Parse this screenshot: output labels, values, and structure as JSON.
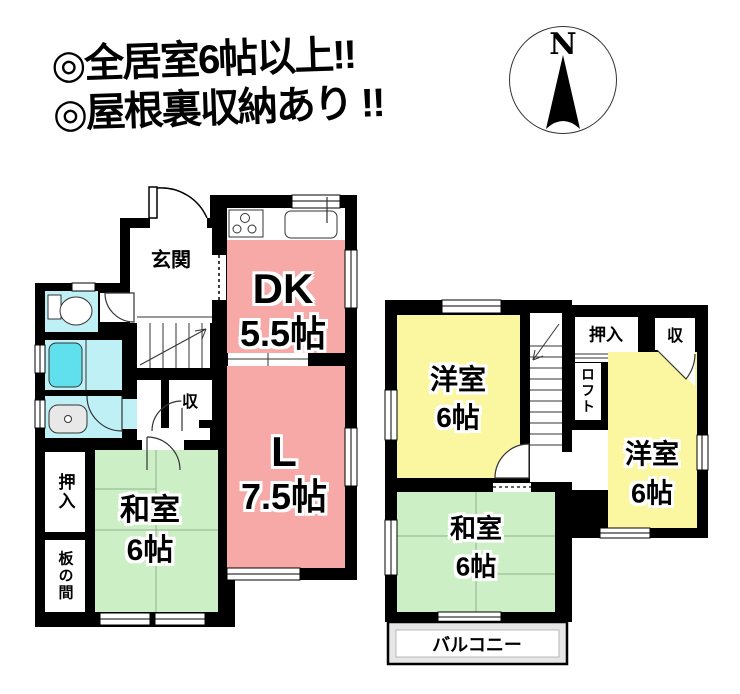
{
  "banner": {
    "line1": "◎全居室6帖以上!!",
    "line2": "◎屋根裏収納あり !!"
  },
  "compass": {
    "label": "N"
  },
  "floor1": {
    "entrance": "玄関",
    "dk_label": "DK",
    "dk_size": "5.5帖",
    "living_label": "L",
    "living_size": "7.5帖",
    "tatami_label": "和室",
    "tatami_size": "6帖",
    "closet": "押入",
    "wood_floor": "板の間",
    "storage": "収"
  },
  "floor2": {
    "western1_label": "洋室",
    "western1_size": "6帖",
    "western2_label": "洋室",
    "western2_size": "6帖",
    "tatami_label": "和室",
    "tatami_size": "6帖",
    "closet": "押入",
    "storage": "収",
    "loft": "ロフト",
    "balcony": "バルコニー"
  },
  "colors": {
    "wall_black": "#000000",
    "room_pink": "#F6A9A7",
    "room_green": "#CDEFC6",
    "room_yellow": "#FBF6A0",
    "water_cyan": "#BFF0F6",
    "tub_cyan": "#5FE0EC",
    "balcony_gray": "#E6E6E6"
  }
}
